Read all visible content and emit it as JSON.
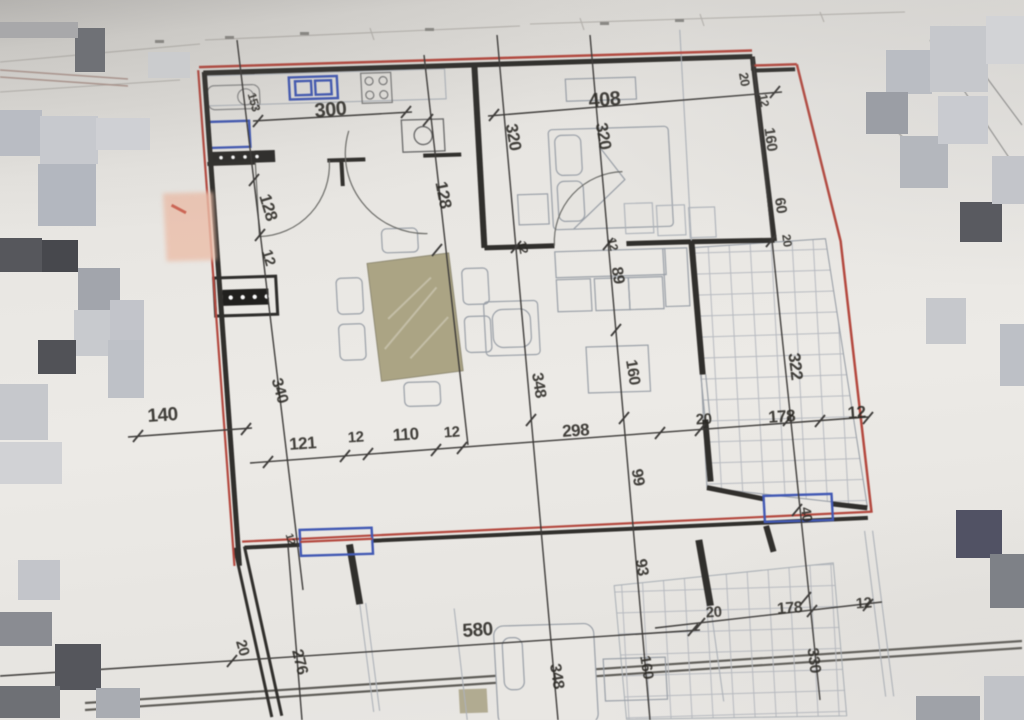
{
  "image_type": "floor plan photo",
  "colors": {
    "paper": "#e9e7e3",
    "wall_black": "#2e2c29",
    "boundary_red": "#b5463c",
    "window_blue": "#3f57b5",
    "dimension_text": "#26241f",
    "hatch_gray": "#b8bbc1",
    "table_tan": "#aca584",
    "highlight_pink": "#eec0aa"
  },
  "dimension_labels": [
    {
      "text": "300",
      "x": 331,
      "y": 116,
      "rot": -5,
      "size": 20
    },
    {
      "text": "153",
      "x": 250,
      "y": 103,
      "rot": 74,
      "size": 12
    },
    {
      "text": "408",
      "x": 605,
      "y": 106,
      "rot": -5,
      "size": 20
    },
    {
      "text": "320",
      "x": 508,
      "y": 138,
      "rot": 80,
      "size": 17
    },
    {
      "text": "320",
      "x": 598,
      "y": 137,
      "rot": 80,
      "size": 17
    },
    {
      "text": "20",
      "x": 740,
      "y": 80,
      "rot": 80,
      "size": 13
    },
    {
      "text": "12",
      "x": 760,
      "y": 101,
      "rot": 80,
      "size": 12
    },
    {
      "text": "160",
      "x": 766,
      "y": 140,
      "rot": 82,
      "size": 15
    },
    {
      "text": "60",
      "x": 776,
      "y": 206,
      "rot": 82,
      "size": 15
    },
    {
      "text": "20",
      "x": 783,
      "y": 241,
      "rot": 82,
      "size": 12
    },
    {
      "text": "128",
      "x": 263,
      "y": 209,
      "rot": 73,
      "size": 17
    },
    {
      "text": "12",
      "x": 264,
      "y": 259,
      "rot": 73,
      "size": 15
    },
    {
      "text": "128",
      "x": 438,
      "y": 196,
      "rot": 79,
      "size": 17
    },
    {
      "text": "12",
      "x": 519,
      "y": 248,
      "rot": 78,
      "size": 12
    },
    {
      "text": "12",
      "x": 609,
      "y": 245,
      "rot": 78,
      "size": 12
    },
    {
      "text": "89",
      "x": 613,
      "y": 276,
      "rot": 81,
      "size": 16
    },
    {
      "text": "160",
      "x": 628,
      "y": 373,
      "rot": 81,
      "size": 16
    },
    {
      "text": "99",
      "x": 633,
      "y": 478,
      "rot": 81,
      "size": 16
    },
    {
      "text": "93",
      "x": 637,
      "y": 568,
      "rot": 81,
      "size": 16
    },
    {
      "text": "348",
      "x": 534,
      "y": 386,
      "rot": 81,
      "size": 16
    },
    {
      "text": "322",
      "x": 790,
      "y": 367,
      "rot": 83,
      "size": 17
    },
    {
      "text": "140",
      "x": 163,
      "y": 421,
      "rot": -4,
      "size": 19
    },
    {
      "text": "340",
      "x": 275,
      "y": 392,
      "rot": 74,
      "size": 16
    },
    {
      "text": "121",
      "x": 303,
      "y": 449,
      "rot": -4,
      "size": 17
    },
    {
      "text": "12",
      "x": 356,
      "y": 442,
      "rot": -4,
      "size": 15
    },
    {
      "text": "110",
      "x": 406,
      "y": 440,
      "rot": -4,
      "size": 17
    },
    {
      "text": "12",
      "x": 452,
      "y": 437,
      "rot": -4,
      "size": 15
    },
    {
      "text": "298",
      "x": 576,
      "y": 436,
      "rot": -4,
      "size": 17
    },
    {
      "text": "20",
      "x": 704,
      "y": 424,
      "rot": -4,
      "size": 15
    },
    {
      "text": "178",
      "x": 782,
      "y": 422,
      "rot": -4,
      "size": 17
    },
    {
      "text": "12",
      "x": 857,
      "y": 418,
      "rot": -4,
      "size": 17
    },
    {
      "text": "40",
      "x": 802,
      "y": 515,
      "rot": 82,
      "size": 14
    },
    {
      "text": "12",
      "x": 287,
      "y": 540,
      "rot": 74,
      "size": 11
    },
    {
      "text": "580",
      "x": 478,
      "y": 636,
      "rot": -4,
      "size": 19
    },
    {
      "text": "20",
      "x": 238,
      "y": 649,
      "rot": 74,
      "size": 15
    },
    {
      "text": "276",
      "x": 295,
      "y": 663,
      "rot": 76,
      "size": 16
    },
    {
      "text": "348",
      "x": 552,
      "y": 677,
      "rot": 81,
      "size": 16
    },
    {
      "text": "160",
      "x": 642,
      "y": 668,
      "rot": 81,
      "size": 15
    },
    {
      "text": "330",
      "x": 809,
      "y": 661,
      "rot": 83,
      "size": 16
    },
    {
      "text": "20",
      "x": 714,
      "y": 617,
      "rot": -4,
      "size": 15
    },
    {
      "text": "178",
      "x": 790,
      "y": 613,
      "rot": -4,
      "size": 16
    },
    {
      "text": "12",
      "x": 864,
      "y": 608,
      "rot": -4,
      "size": 15
    }
  ],
  "pixel_blocks": [
    {
      "x": 75,
      "y": 28,
      "w": 30,
      "h": 44,
      "c": "#6f7176"
    },
    {
      "x": 0,
      "y": 22,
      "w": 78,
      "h": 16,
      "c": "#a8a8aa"
    },
    {
      "x": 148,
      "y": 52,
      "w": 42,
      "h": 26,
      "c": "#cbccce"
    },
    {
      "x": 0,
      "y": 110,
      "w": 42,
      "h": 46,
      "c": "#b9bcc3"
    },
    {
      "x": 40,
      "y": 116,
      "w": 58,
      "h": 48,
      "c": "#c7c9ce"
    },
    {
      "x": 38,
      "y": 164,
      "w": 58,
      "h": 62,
      "c": "#b3b7bf"
    },
    {
      "x": 96,
      "y": 118,
      "w": 54,
      "h": 32,
      "c": "#cfd0d4"
    },
    {
      "x": 0,
      "y": 238,
      "w": 42,
      "h": 34,
      "c": "#56575c"
    },
    {
      "x": 42,
      "y": 240,
      "w": 36,
      "h": 32,
      "c": "#47484d"
    },
    {
      "x": 78,
      "y": 268,
      "w": 42,
      "h": 42,
      "c": "#a2a5ac"
    },
    {
      "x": 74,
      "y": 310,
      "w": 42,
      "h": 46,
      "c": "#c8cace"
    },
    {
      "x": 110,
      "y": 300,
      "w": 34,
      "h": 42,
      "c": "#c2c4ca"
    },
    {
      "x": 38,
      "y": 340,
      "w": 38,
      "h": 34,
      "c": "#515257"
    },
    {
      "x": 108,
      "y": 340,
      "w": 36,
      "h": 58,
      "c": "#bec1c7"
    },
    {
      "x": 0,
      "y": 384,
      "w": 48,
      "h": 56,
      "c": "#c6c8cc"
    },
    {
      "x": 0,
      "y": 442,
      "w": 62,
      "h": 42,
      "c": "#d1d2d5"
    },
    {
      "x": 18,
      "y": 560,
      "w": 42,
      "h": 40,
      "c": "#c3c5ca"
    },
    {
      "x": 0,
      "y": 612,
      "w": 52,
      "h": 34,
      "c": "#8a8c92"
    },
    {
      "x": 55,
      "y": 644,
      "w": 46,
      "h": 46,
      "c": "#55565c"
    },
    {
      "x": 0,
      "y": 686,
      "w": 60,
      "h": 32,
      "c": "#6e7075"
    },
    {
      "x": 96,
      "y": 688,
      "w": 44,
      "h": 30,
      "c": "#a9acb2"
    },
    {
      "x": 886,
      "y": 50,
      "w": 46,
      "h": 44,
      "c": "#babdc3"
    },
    {
      "x": 930,
      "y": 26,
      "w": 58,
      "h": 66,
      "c": "#c6c8cc"
    },
    {
      "x": 986,
      "y": 16,
      "w": 38,
      "h": 48,
      "c": "#d2d3d6"
    },
    {
      "x": 866,
      "y": 92,
      "w": 42,
      "h": 42,
      "c": "#9b9ea5"
    },
    {
      "x": 900,
      "y": 136,
      "w": 48,
      "h": 52,
      "c": "#b4b7bd"
    },
    {
      "x": 938,
      "y": 96,
      "w": 50,
      "h": 48,
      "c": "#c9cbd0"
    },
    {
      "x": 960,
      "y": 202,
      "w": 42,
      "h": 40,
      "c": "#595a60"
    },
    {
      "x": 992,
      "y": 156,
      "w": 32,
      "h": 48,
      "c": "#c3c5ca"
    },
    {
      "x": 926,
      "y": 298,
      "w": 40,
      "h": 46,
      "c": "#c6c8cc"
    },
    {
      "x": 1000,
      "y": 324,
      "w": 24,
      "h": 62,
      "c": "#bdc0c6"
    },
    {
      "x": 956,
      "y": 510,
      "w": 46,
      "h": 48,
      "c": "#515264"
    },
    {
      "x": 990,
      "y": 554,
      "w": 34,
      "h": 54,
      "c": "#7e8187"
    },
    {
      "x": 916,
      "y": 696,
      "w": 64,
      "h": 24,
      "c": "#9fa2a8"
    },
    {
      "x": 984,
      "y": 676,
      "w": 40,
      "h": 44,
      "c": "#c1c3c8"
    }
  ]
}
